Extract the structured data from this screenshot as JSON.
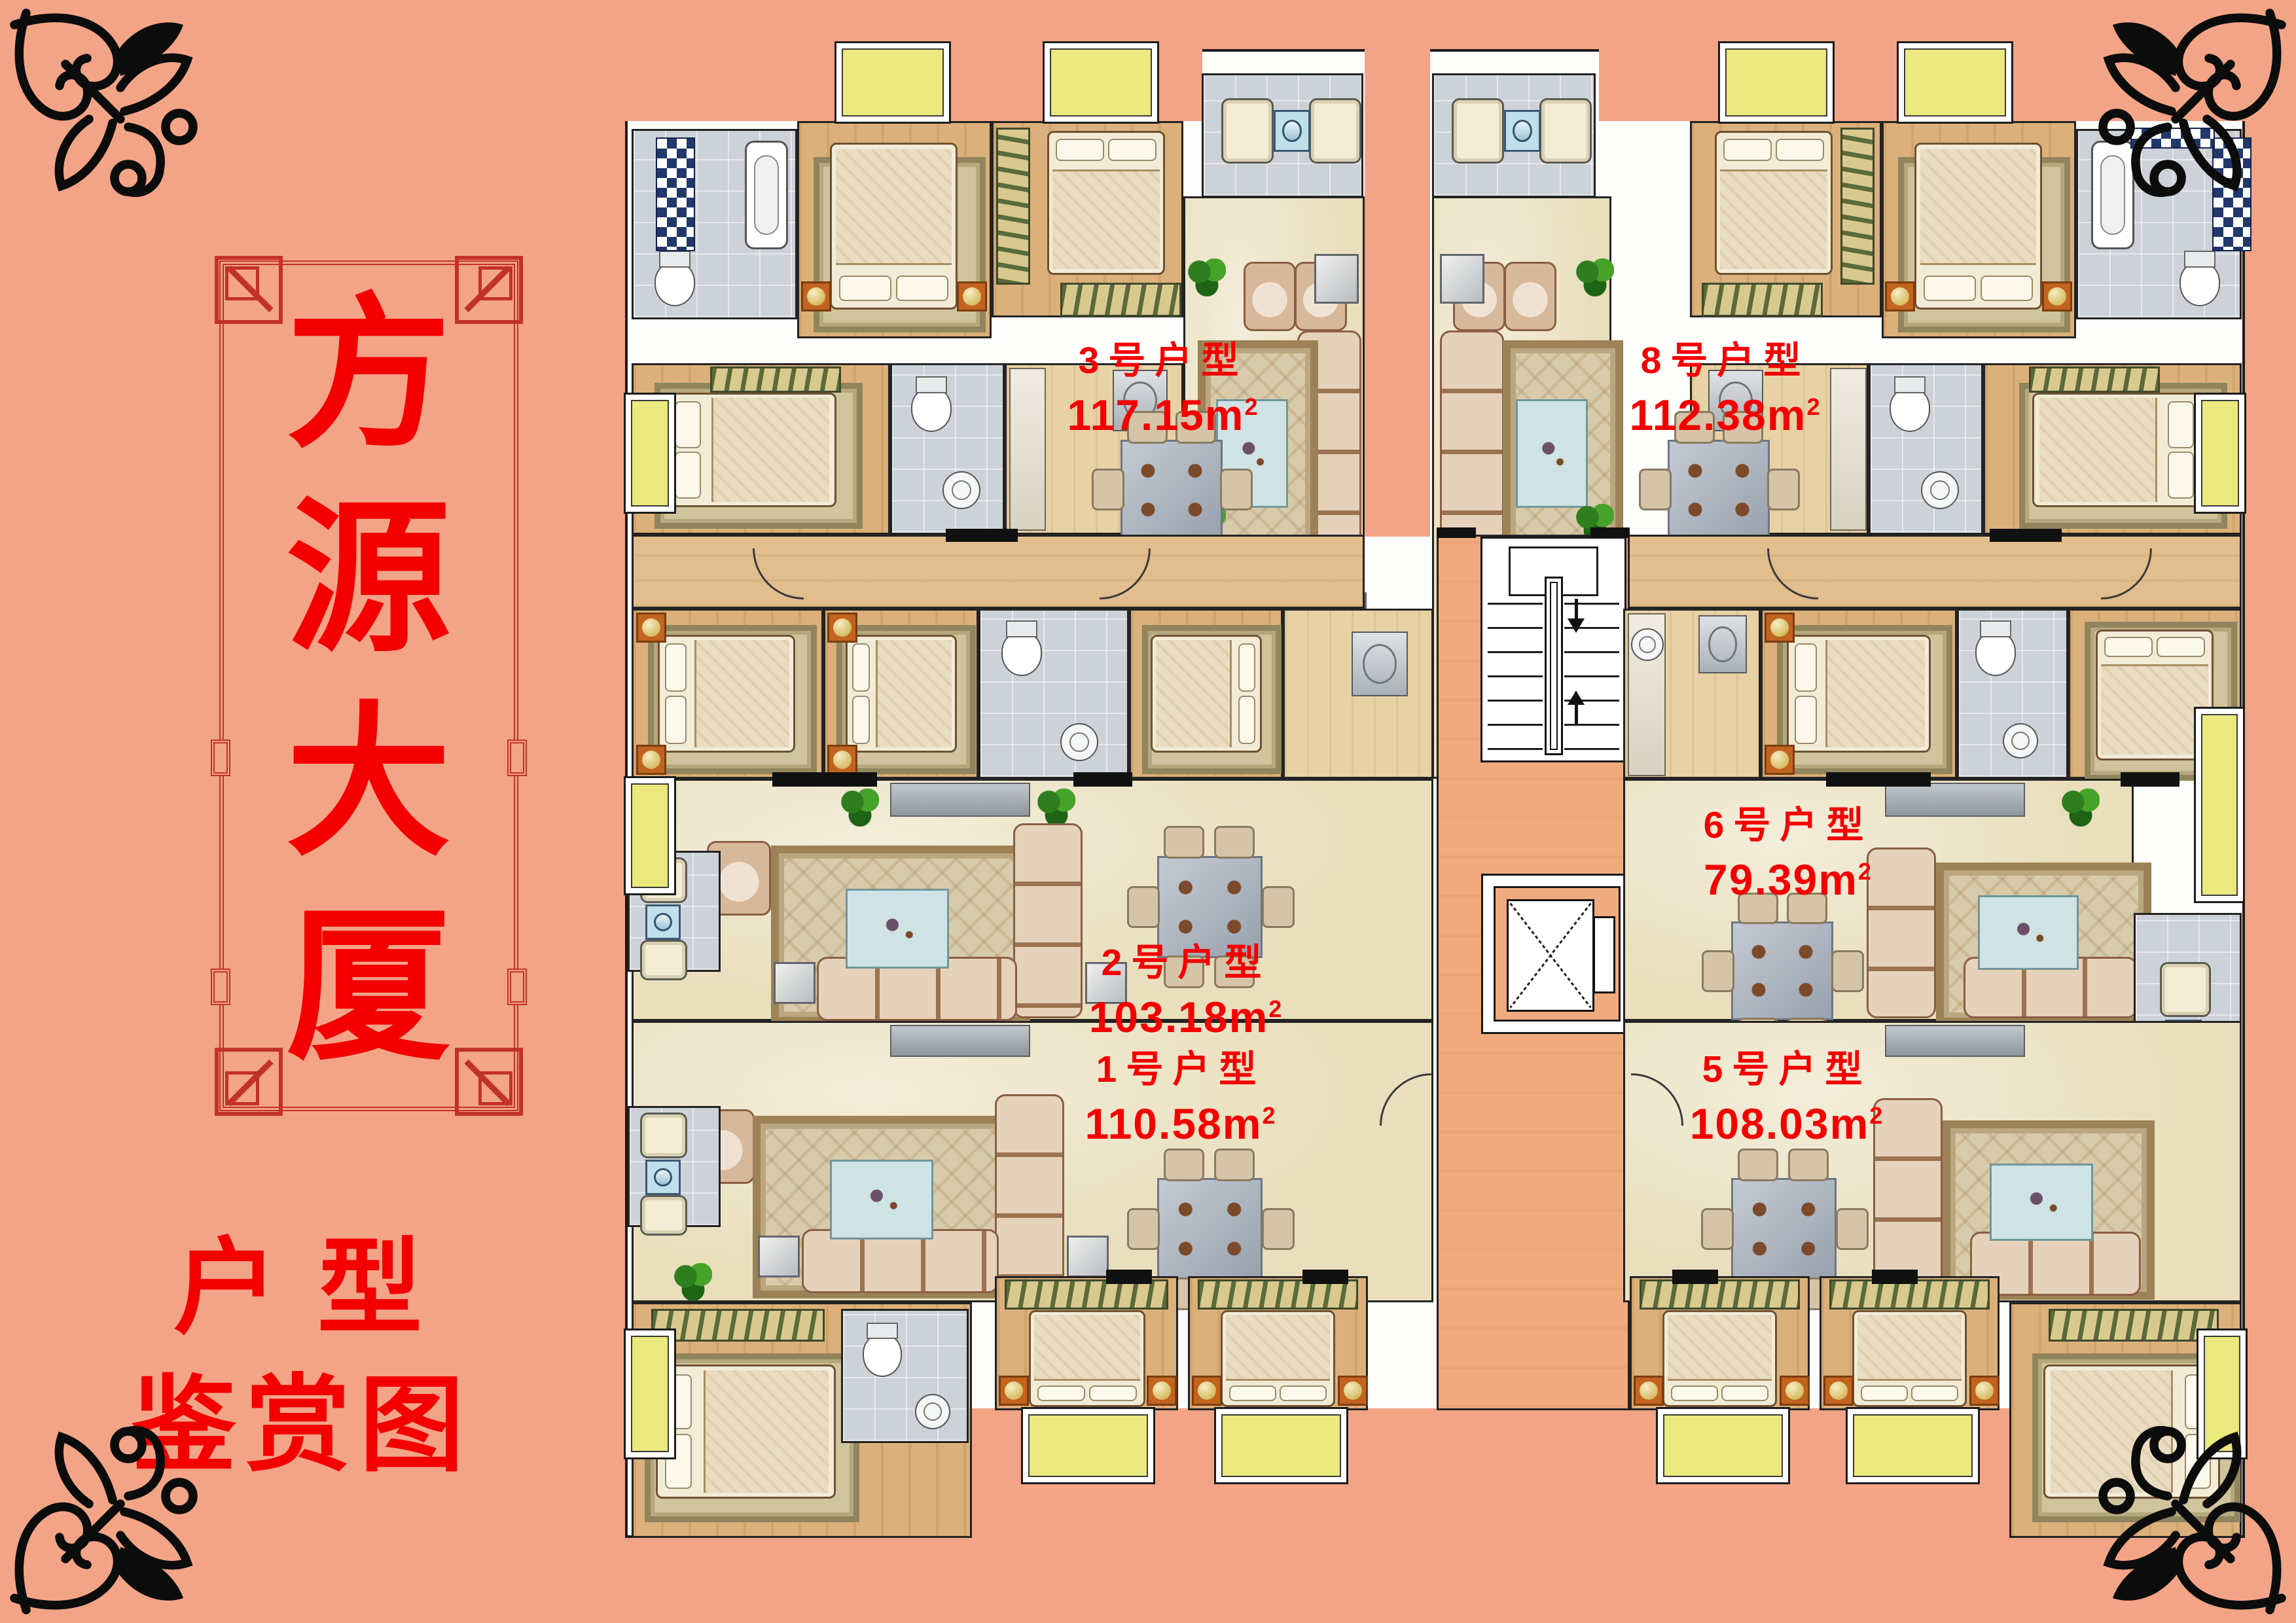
{
  "poster": {
    "title_chars": [
      "方",
      "源",
      "大",
      "厦"
    ],
    "subtitle_lines": [
      "户型",
      "鉴赏图"
    ]
  },
  "plan": {
    "units": [
      {
        "name": "3号户型",
        "area": "117.15"
      },
      {
        "name": "8号户型",
        "area": "112.38"
      },
      {
        "name": "2号户型",
        "area": "103.18"
      },
      {
        "name": "6号户型",
        "area": "79.39"
      },
      {
        "name": "1号户型",
        "area": "110.58"
      },
      {
        "name": "5号户型",
        "area": "108.03"
      }
    ],
    "area_unit": {
      "base": "m",
      "exponent": "2"
    }
  },
  "colors": {
    "bg": "#f3a487",
    "accent_red": "#f40000",
    "frame_red": "#c3312b",
    "balcony_yellow": "#ebe87e",
    "checker_navy": "#22386b",
    "floor_wood": "#dcb07a",
    "floor_marble": "#e9dfbd",
    "floor_tile": "#cdd2d8",
    "corridor_salmon": "#f0aa7e"
  }
}
